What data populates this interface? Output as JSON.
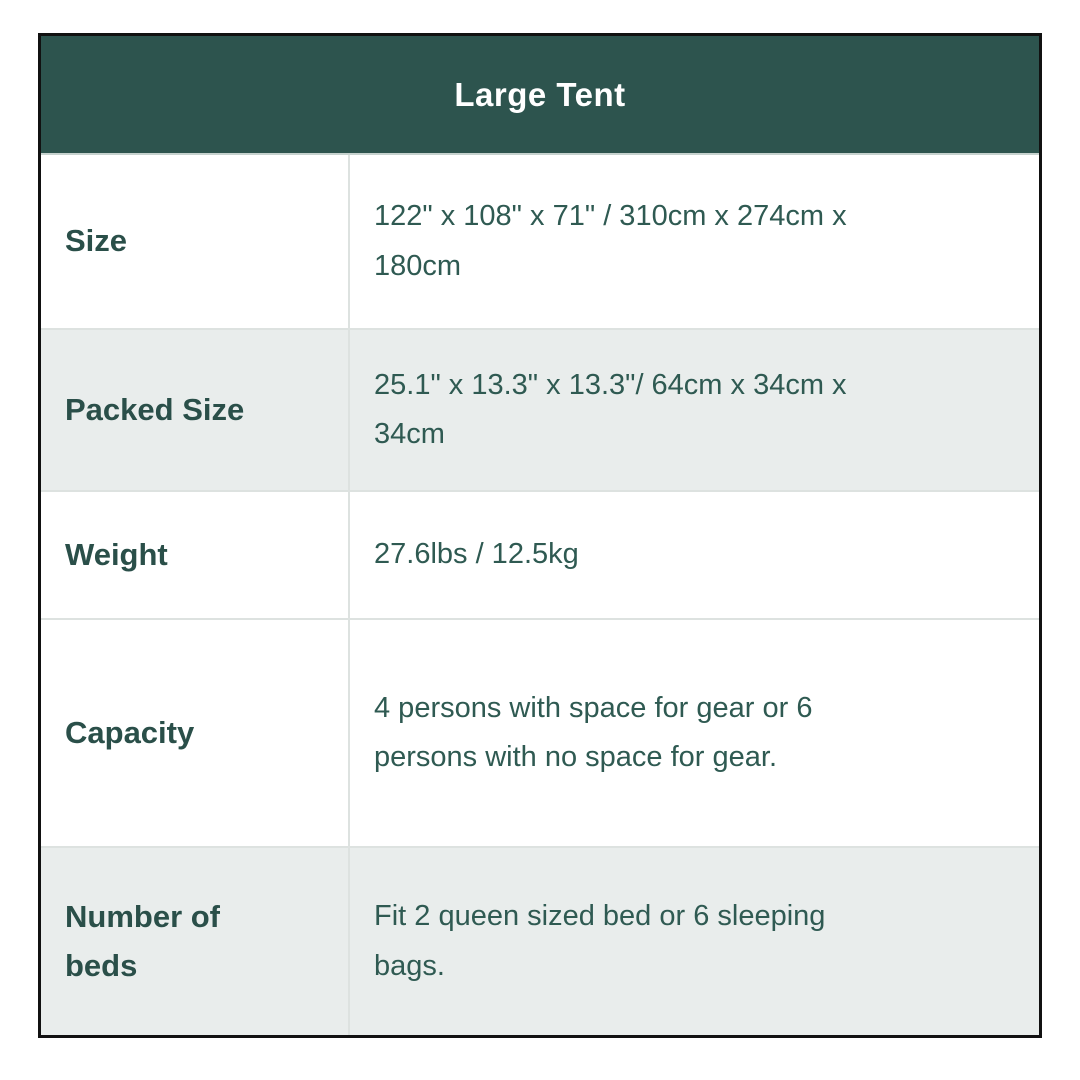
{
  "chart_data": {
    "type": "table",
    "title": "Large Tent",
    "columns": [
      "attribute",
      "value"
    ],
    "rows": [
      {
        "label": "Size",
        "value": "122\" x 108\" x 71\" / 310cm x 274cm x 180cm",
        "shaded": false
      },
      {
        "label": "Packed Size",
        "value": "25.1\" x 13.3\" x 13.3\"/ 64cm x 34cm x 34cm",
        "shaded": true
      },
      {
        "label": "Weight",
        "value": "27.6lbs / 12.5kg",
        "shaded": false
      },
      {
        "label": "Capacity",
        "value": "4 persons with space for gear or 6 persons with no space for gear.",
        "shaded": false
      },
      {
        "label": "Number of beds",
        "value": "Fit 2 queen sized bed or 6 sleeping bags.",
        "shaded": true
      }
    ],
    "colors": {
      "header_bg": "#2d544e",
      "header_text": "#ffffff",
      "label_text": "#2a4f49",
      "value_text": "#2f5a52",
      "row_bg": "#ffffff",
      "row_alt_bg": "#e9edec",
      "border": "#111111",
      "grid_line": "#dde2e0"
    }
  }
}
